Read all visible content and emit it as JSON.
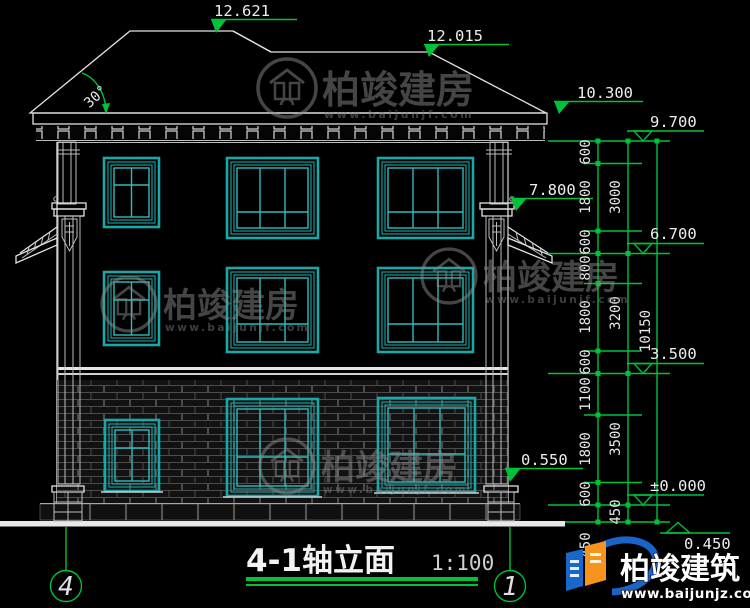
{
  "title": {
    "text": "4-1轴立面",
    "scale": "1:100"
  },
  "axes": {
    "left": "4",
    "right": "1"
  },
  "roof": {
    "slope_label": "30°"
  },
  "elevation_markers": {
    "ridge_main": "12.621",
    "ridge_secondary": "12.015",
    "eave": "10.300",
    "capital": "7.800",
    "plinth": "0.550",
    "right": [
      "9.700",
      "6.700",
      "3.500",
      "±0.000",
      "0.450"
    ]
  },
  "dimensions": {
    "col1": [
      "600",
      "1800",
      "600",
      "800",
      "1800",
      "600",
      "1100",
      "1800",
      "600",
      "450"
    ],
    "col2": [
      "3000",
      "3200",
      "3500",
      "450"
    ],
    "col3": [
      "10150"
    ]
  },
  "watermark": {
    "name": "柏竣建房",
    "url": "www.baijunjf.com"
  },
  "brand": {
    "name": "柏竣建筑",
    "url": "www.baijunjz.com"
  },
  "colors": {
    "background": "#000000",
    "line_white": "#e2e2e2",
    "dimension_green": "#00c23a",
    "window_teal": "#1aa7a7",
    "brand_blue": "#1a63c8",
    "brand_orange": "#f7941d"
  }
}
